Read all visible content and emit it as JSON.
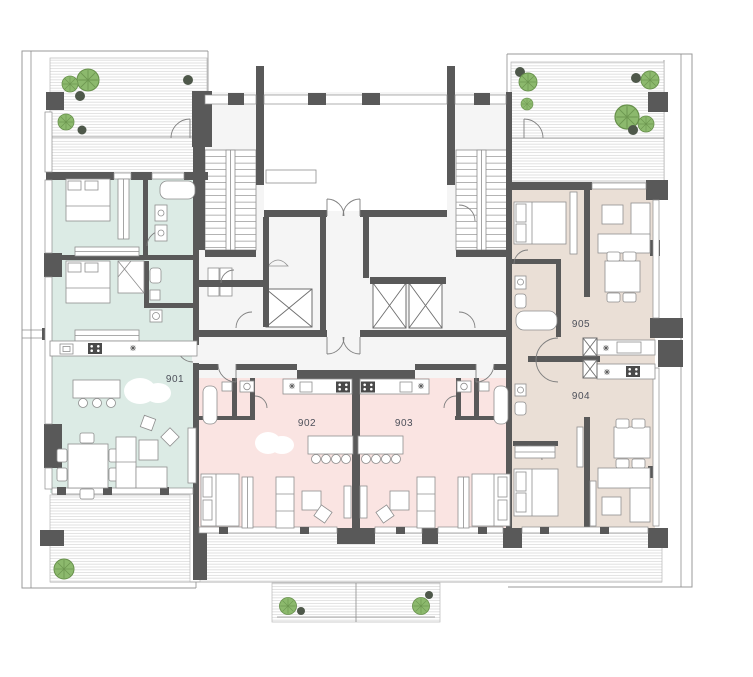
{
  "plan": {
    "type": "residential-floor-plan",
    "units": [
      {
        "id": "unit-901",
        "label": "901",
        "color": "#dcebe5"
      },
      {
        "id": "unit-902",
        "label": "902",
        "color": "#fae4e2"
      },
      {
        "id": "unit-903",
        "label": "903",
        "color": "#fae4e2"
      },
      {
        "id": "unit-904",
        "label": "904",
        "color": "#eadfd6"
      },
      {
        "id": "unit-905",
        "label": "905",
        "color": "#eadfd6"
      }
    ],
    "colors": {
      "wall": "#595959",
      "line": "#8d8d8d",
      "hatch": "#cfcfcf",
      "treeGreen": "#8cb96d",
      "treeDark": "#4e584a",
      "treeStroke": "#67904b",
      "label": "#4d505a"
    }
  }
}
